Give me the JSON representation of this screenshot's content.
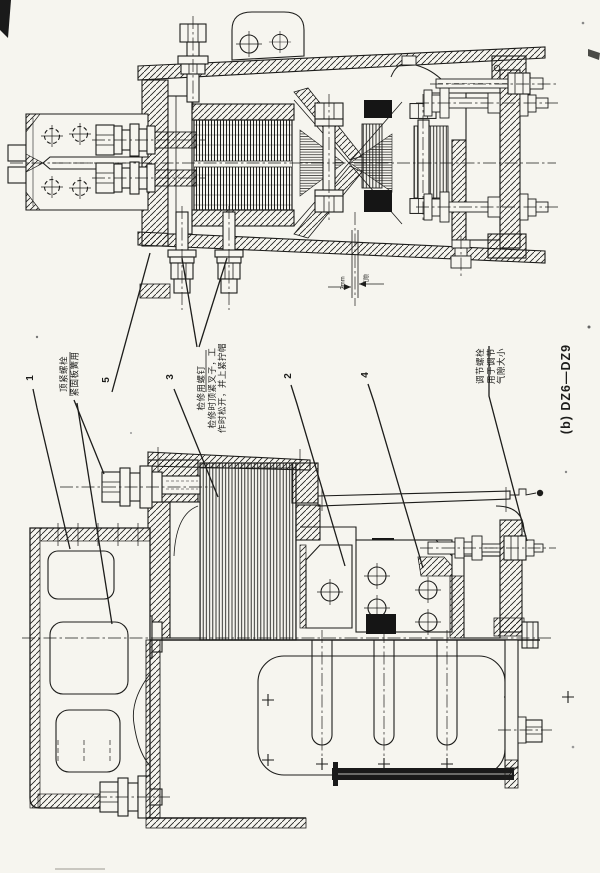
{
  "figure": {
    "caption": "(b) DZ6—DZ9",
    "callouts": {
      "n1": "1",
      "n2": "2",
      "n3": "3",
      "n4": "4",
      "n5": "5"
    },
    "labels": {
      "top_tighten_bolt": "顶紧螺栓\n紧固板簧用",
      "service_screw": "检修用螺钉\n检修时顶紧叉子，工\n作时松开，并上紧拧帽",
      "adjust_bolt": "调节螺栓\n用于调节\n气隙大小"
    },
    "dimension": {
      "gap_value": "2mm",
      "gap_label": "气隙"
    }
  },
  "colors": {
    "ink": "#1d1d1b",
    "paper": "#f6f5ef"
  }
}
